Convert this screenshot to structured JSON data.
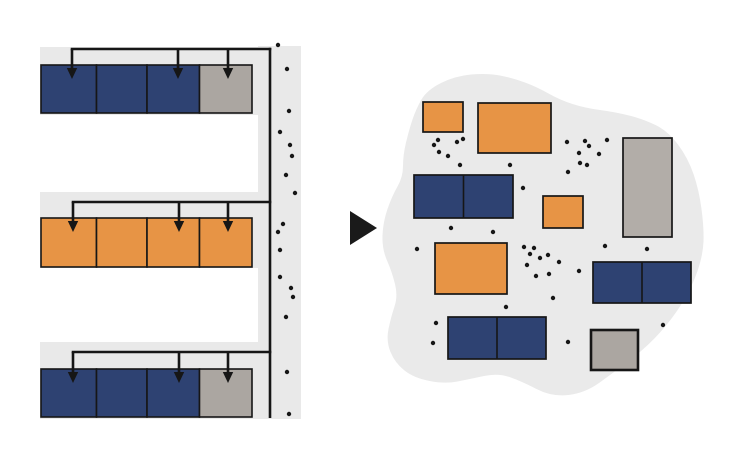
{
  "canvas": {
    "width": 748,
    "height": 456,
    "background": "#ffffff"
  },
  "colors": {
    "blue": "#2e4272",
    "orange": "#e79445",
    "gray": "#aba6a1",
    "gray_light": "#b2ada8",
    "strip": "#e9e9e9",
    "blob": "#eaeaea",
    "ink": "#161616"
  },
  "left_panel": {
    "meaning": "structured-memory-rows-with-pointers",
    "block_edges": [
      41,
      96.5,
      147,
      199.5,
      252
    ],
    "rows": [
      {
        "strip": {
          "x": 40,
          "y": 47,
          "w": 218,
          "h": 68
        },
        "line_y": 49,
        "block_y": 65,
        "block_h": 48,
        "block_colors": [
          "blue",
          "blue",
          "blue",
          "gray"
        ],
        "arrow_xs": [
          72,
          178,
          228
        ]
      },
      {
        "strip": {
          "x": 40,
          "y": 192,
          "w": 218,
          "h": 76
        },
        "line_y": 202,
        "block_y": 218,
        "block_h": 49,
        "block_colors": [
          "orange",
          "orange",
          "orange",
          "orange"
        ],
        "arrow_xs": [
          73,
          179,
          228
        ]
      },
      {
        "strip": {
          "x": 40,
          "y": 342,
          "w": 218,
          "h": 77
        },
        "line_y": 352,
        "block_y": 369,
        "block_h": 48,
        "block_colors": [
          "blue",
          "blue",
          "blue",
          "gray"
        ],
        "arrow_xs": [
          73,
          179,
          228
        ]
      }
    ],
    "spine": {
      "strip": {
        "x": 258,
        "y": 46,
        "w": 43,
        "h": 373
      },
      "line_x": 270,
      "line_y1": 47.7,
      "line_y2": 418,
      "dots": [
        [
          278,
          45
        ],
        [
          287,
          69
        ],
        [
          289,
          111
        ],
        [
          280,
          132
        ],
        [
          290,
          145
        ],
        [
          292,
          156
        ],
        [
          286,
          175
        ],
        [
          295,
          193
        ],
        [
          283,
          224
        ],
        [
          278,
          232
        ],
        [
          280,
          250
        ],
        [
          280,
          277
        ],
        [
          291,
          288
        ],
        [
          293,
          297
        ],
        [
          286,
          317
        ],
        [
          287,
          372
        ],
        [
          289,
          414
        ]
      ]
    }
  },
  "transform_arrow": {
    "points": [
      [
        350,
        211
      ],
      [
        350,
        245
      ],
      [
        377,
        228
      ]
    ]
  },
  "right_panel": {
    "meaning": "fragmented-heap-blob",
    "blob_points": [
      [
        427,
        90
      ],
      [
        455,
        76
      ],
      [
        487,
        73
      ],
      [
        513,
        78
      ],
      [
        537,
        87
      ],
      [
        560,
        100
      ],
      [
        585,
        108
      ],
      [
        615,
        112
      ],
      [
        643,
        119
      ],
      [
        668,
        131
      ],
      [
        688,
        158
      ],
      [
        699,
        190
      ],
      [
        704,
        228
      ],
      [
        703,
        255
      ],
      [
        692,
        287
      ],
      [
        673,
        318
      ],
      [
        647,
        347
      ],
      [
        613,
        373
      ],
      [
        585,
        393
      ],
      [
        552,
        397
      ],
      [
        521,
        381
      ],
      [
        498,
        373
      ],
      [
        470,
        379
      ],
      [
        445,
        384
      ],
      [
        414,
        378
      ],
      [
        395,
        363
      ],
      [
        386,
        341
      ],
      [
        391,
        317
      ],
      [
        398,
        296
      ],
      [
        392,
        272
      ],
      [
        382,
        249
      ],
      [
        383,
        222
      ],
      [
        392,
        196
      ],
      [
        403,
        177
      ],
      [
        403,
        155
      ],
      [
        409,
        130
      ],
      [
        416,
        109
      ]
    ],
    "rects": [
      {
        "x": 423,
        "y": 102,
        "w": 40,
        "h": 30,
        "color": "orange",
        "cells": 1,
        "sw": 1.7
      },
      {
        "x": 478,
        "y": 103,
        "w": 73,
        "h": 50,
        "color": "orange",
        "cells": 1,
        "sw": 1.7
      },
      {
        "x": 623,
        "y": 138,
        "w": 49,
        "h": 99,
        "color": "gray_light",
        "cells": 1,
        "sw": 1.7
      },
      {
        "x": 414,
        "y": 175,
        "w": 99,
        "h": 43,
        "color": "blue",
        "cells": 2,
        "sw": 1.7
      },
      {
        "x": 543,
        "y": 196,
        "w": 40,
        "h": 32,
        "color": "orange",
        "cells": 1,
        "sw": 1.7
      },
      {
        "x": 435,
        "y": 243,
        "w": 72,
        "h": 51,
        "color": "orange",
        "cells": 1,
        "sw": 1.7
      },
      {
        "x": 593,
        "y": 262,
        "w": 98,
        "h": 41,
        "color": "blue",
        "cells": 2,
        "sw": 1.7
      },
      {
        "x": 448,
        "y": 317,
        "w": 98,
        "h": 42,
        "color": "blue",
        "cells": 2,
        "sw": 1.7
      },
      {
        "x": 591,
        "y": 330,
        "w": 47,
        "h": 40,
        "color": "gray",
        "cells": 1,
        "sw": 2.6
      }
    ],
    "dots": [
      [
        438,
        140
      ],
      [
        434,
        145
      ],
      [
        457,
        142
      ],
      [
        463,
        139
      ],
      [
        439,
        152
      ],
      [
        448,
        156
      ],
      [
        460,
        165
      ],
      [
        510,
        165
      ],
      [
        523,
        188
      ],
      [
        567,
        142
      ],
      [
        585,
        141
      ],
      [
        589,
        146
      ],
      [
        607,
        140
      ],
      [
        579,
        153
      ],
      [
        599,
        154
      ],
      [
        580,
        163
      ],
      [
        587,
        165
      ],
      [
        568,
        172
      ],
      [
        451,
        228
      ],
      [
        493,
        232
      ],
      [
        417,
        249
      ],
      [
        605,
        246
      ],
      [
        647,
        249
      ],
      [
        524,
        247
      ],
      [
        534,
        248
      ],
      [
        530,
        254
      ],
      [
        548,
        255
      ],
      [
        540,
        258
      ],
      [
        559,
        262
      ],
      [
        527,
        265
      ],
      [
        536,
        276
      ],
      [
        549,
        274
      ],
      [
        579,
        271
      ],
      [
        553,
        298
      ],
      [
        506,
        307
      ],
      [
        436,
        323
      ],
      [
        663,
        325
      ],
      [
        433,
        343
      ],
      [
        568,
        342
      ]
    ]
  },
  "style": {
    "connector_width": 2.6,
    "block_stroke_width": 1.6,
    "dot_radius": 2.2,
    "arrow_tip_depth": 14,
    "arrowhead_w": 10.4,
    "arrowhead_h": 11
  }
}
